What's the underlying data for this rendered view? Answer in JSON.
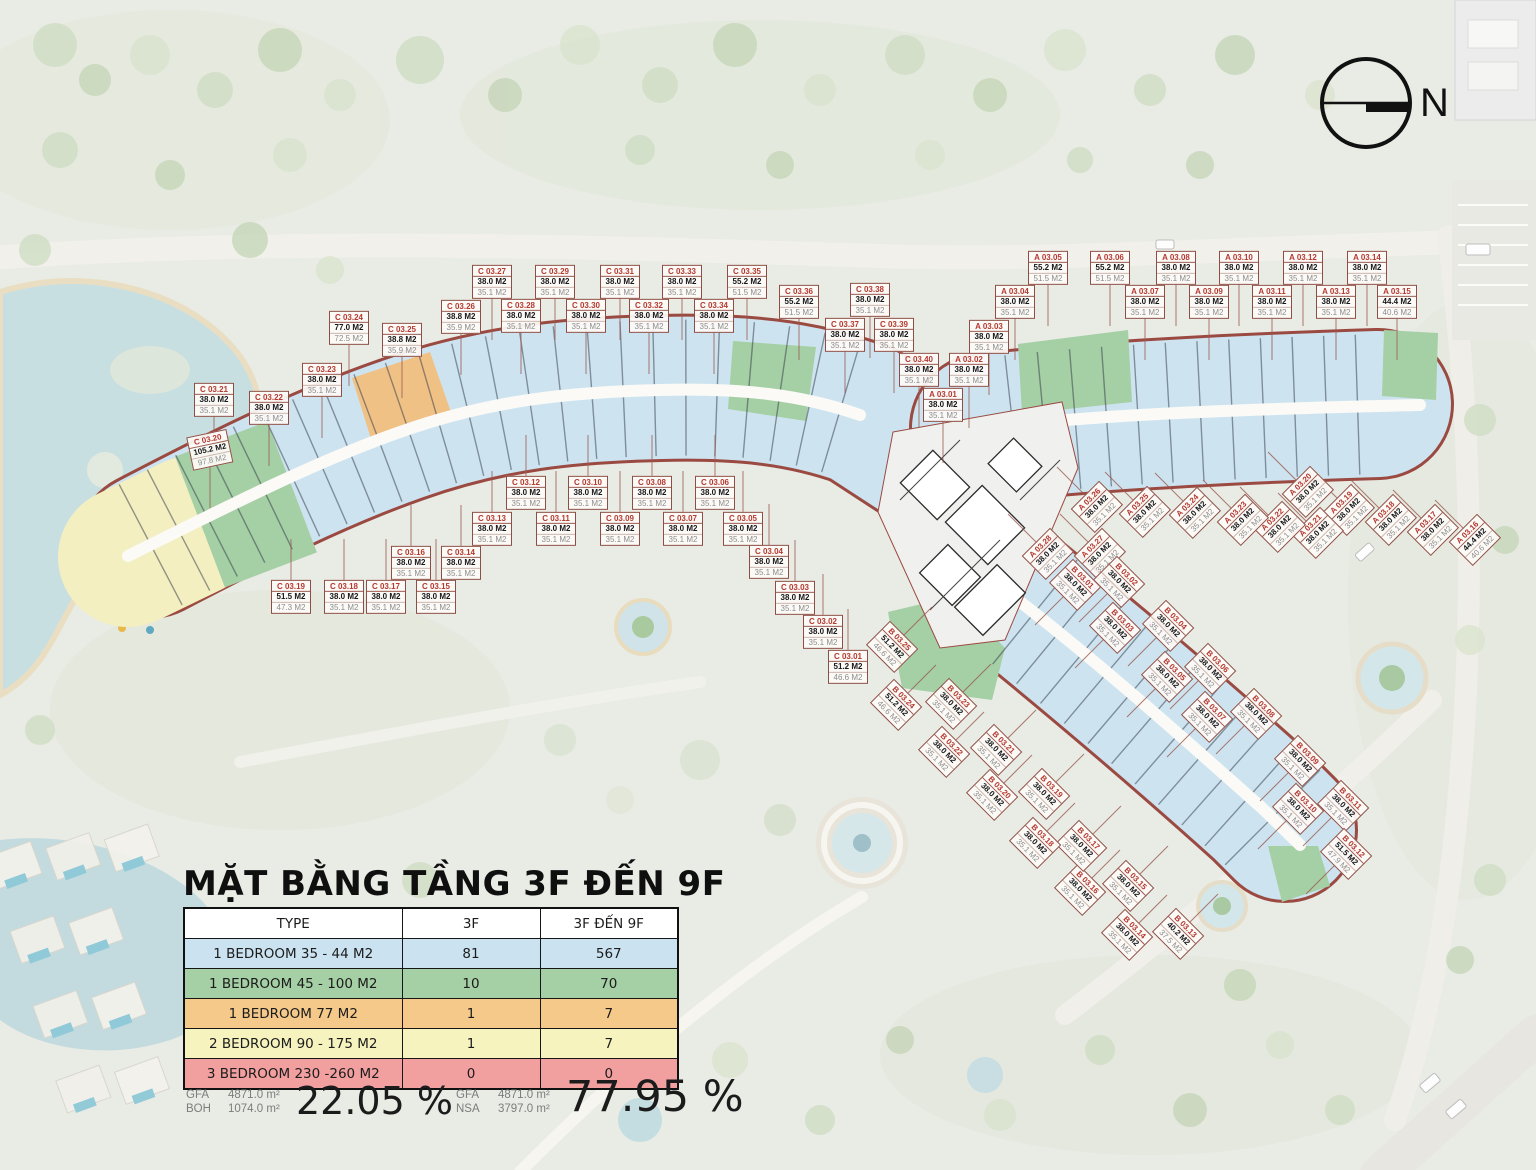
{
  "title": "MẶT BẰNG TẦNG 3F ĐẾN 9F",
  "compass": {
    "label": "N"
  },
  "legend_table": {
    "headers": [
      "TYPE",
      "3F",
      "3F ĐẾN 9F"
    ],
    "rows": [
      {
        "type": "1 BEDROOM 35 - 44 M2",
        "f3": "81",
        "f3_9": "567",
        "color": "#cbe3f1"
      },
      {
        "type": "1 BEDROOM 45 - 100 M2",
        "f3": "10",
        "f3_9": "70",
        "color": "#a5cfa4"
      },
      {
        "type": "1 BEDROOM 77 M2",
        "f3": "1",
        "f3_9": "7",
        "color": "#f5c98a"
      },
      {
        "type": "2 BEDROOM 90 - 175 M2",
        "f3": "1",
        "f3_9": "7",
        "color": "#f6f3bf"
      },
      {
        "type": "3 BEDROOM 230 -260 M2",
        "f3": "0",
        "f3_9": "0",
        "color": "#f19f9f"
      }
    ]
  },
  "stats": {
    "left": {
      "l1": "GFA",
      "v1": "4871.0 m²",
      "l2": "BOH",
      "v2": "1074.0 m²",
      "percent": "22.05 %"
    },
    "right": {
      "l1": "GFA",
      "v1": "4871.0 m²",
      "l2": "NSA",
      "v2": "3797.0 m²",
      "percent": "77.95 %"
    }
  },
  "colors": {
    "unit_blue": "#cde4f0",
    "unit_green": "#a5cfa4",
    "unit_orange": "#f0c185",
    "unit_yellow": "#f3efc0",
    "unit_red": "#f19f9f",
    "boundary_red": "#9b4a42"
  },
  "units": [
    [
      "C 03.01",
      "51.2 M2",
      "46.6 M2",
      848,
      667,
      0,
      "u"
    ],
    [
      "C 03.02",
      "38.0 M2",
      "35.1 M2",
      823,
      632,
      0,
      "u"
    ],
    [
      "C 03.03",
      "38.0 M2",
      "35.1 M2",
      795,
      598,
      0,
      "u"
    ],
    [
      "C 03.04",
      "38.0 M2",
      "35.1 M2",
      769,
      562,
      0,
      "u"
    ],
    [
      "C 03.05",
      "38.0 M2",
      "35.1 M2",
      743,
      529,
      0,
      "u"
    ],
    [
      "C 03.06",
      "38.0 M2",
      "35.1 M2",
      715,
      493,
      0,
      "u"
    ],
    [
      "C 03.07",
      "38.0 M2",
      "35.1 M2",
      683,
      529,
      0,
      "u"
    ],
    [
      "C 03.08",
      "38.0 M2",
      "35.1 M2",
      652,
      493,
      0,
      "u"
    ],
    [
      "C 03.09",
      "38.0 M2",
      "35.1 M2",
      620,
      529,
      0,
      "u"
    ],
    [
      "C 03.10",
      "38.0 M2",
      "35.1 M2",
      588,
      493,
      0,
      "u"
    ],
    [
      "C 03.11",
      "38.0 M2",
      "35.1 M2",
      556,
      529,
      0,
      "u"
    ],
    [
      "C 03.12",
      "38.0 M2",
      "35.1 M2",
      526,
      493,
      0,
      "u"
    ],
    [
      "C 03.13",
      "38.0 M2",
      "35.1 M2",
      492,
      529,
      0,
      "u"
    ],
    [
      "C 03.14",
      "38.0 M2",
      "35.1 M2",
      461,
      563,
      0,
      "u"
    ],
    [
      "C 03.15",
      "38.0 M2",
      "35.1 M2",
      436,
      597,
      0,
      "u"
    ],
    [
      "C 03.16",
      "38.0 M2",
      "35.1 M2",
      411,
      563,
      0,
      "u"
    ],
    [
      "C 03.17",
      "38.0 M2",
      "35.1 M2",
      386,
      597,
      0,
      "u"
    ],
    [
      "C 03.18",
      "38.0 M2",
      "35.1 M2",
      344,
      597,
      0,
      "u"
    ],
    [
      "C 03.19",
      "51.5 M2",
      "47.3 M2",
      291,
      597,
      0,
      "u"
    ],
    [
      "C 03.20",
      "105.2 M2",
      "97.8 M2",
      210,
      450,
      -12,
      "d"
    ],
    [
      "C 03.21",
      "38.0 M2",
      "35.1 M2",
      214,
      400,
      0,
      "d"
    ],
    [
      "C 03.22",
      "38.0 M2",
      "35.1 M2",
      269,
      408,
      0,
      "d"
    ],
    [
      "C 03.23",
      "38.0 M2",
      "35.1 M2",
      322,
      380,
      0,
      "d"
    ],
    [
      "C 03.24",
      "77.0 M2",
      "72.5 M2",
      349,
      328,
      0,
      "d"
    ],
    [
      "C 03.25",
      "38.8 M2",
      "35.9 M2",
      402,
      340,
      0,
      "d"
    ],
    [
      "C 03.26",
      "38.8 M2",
      "35.9 M2",
      461,
      317,
      0,
      "d"
    ],
    [
      "C 03.27",
      "38.0 M2",
      "35.1 M2",
      492,
      282,
      0,
      "d"
    ],
    [
      "C 03.28",
      "38.0 M2",
      "35.1 M2",
      521,
      316,
      0,
      "d"
    ],
    [
      "C 03.29",
      "38.0 M2",
      "35.1 M2",
      555,
      282,
      0,
      "d"
    ],
    [
      "C 03.30",
      "38.0 M2",
      "35.1 M2",
      586,
      316,
      0,
      "d"
    ],
    [
      "C 03.31",
      "38.0 M2",
      "35.1 M2",
      620,
      282,
      0,
      "d"
    ],
    [
      "C 03.32",
      "38.0 M2",
      "35.1 M2",
      649,
      316,
      0,
      "d"
    ],
    [
      "C 03.33",
      "38.0 M2",
      "35.1 M2",
      682,
      282,
      0,
      "d"
    ],
    [
      "C 03.34",
      "38.0 M2",
      "35.1 M2",
      714,
      316,
      0,
      "d"
    ],
    [
      "C 03.35",
      "55.2 M2",
      "51.5 M2",
      747,
      282,
      0,
      "d"
    ],
    [
      "C 03.36",
      "55.2 M2",
      "51.5 M2",
      799,
      302,
      0,
      "d"
    ],
    [
      "C 03.37",
      "38.0 M2",
      "35.1 M2",
      845,
      335,
      0,
      "d"
    ],
    [
      "C 03.38",
      "38.0 M2",
      "35.1 M2",
      870,
      300,
      0,
      "d"
    ],
    [
      "C 03.39",
      "38.0 M2",
      "35.1 M2",
      894,
      335,
      0,
      "d"
    ],
    [
      "C 03.40",
      "38.0 M2",
      "35.1 M2",
      919,
      370,
      0,
      "d"
    ],
    [
      "A 03.01",
      "38.0 M2",
      "35.1 M2",
      943,
      405,
      0,
      "d"
    ],
    [
      "A 03.02",
      "38.0 M2",
      "35.1 M2",
      969,
      370,
      0,
      "d"
    ],
    [
      "A 03.03",
      "38.0 M2",
      "35.1 M2",
      989,
      337,
      0,
      "d"
    ],
    [
      "A 03.04",
      "38.0 M2",
      "35.1 M2",
      1015,
      302,
      0,
      "d"
    ],
    [
      "A 03.05",
      "55.2 M2",
      "51.5 M2",
      1048,
      268,
      0,
      "d"
    ],
    [
      "A 03.06",
      "55.2 M2",
      "51.5 M2",
      1110,
      268,
      0,
      "d"
    ],
    [
      "A 03.07",
      "38.0 M2",
      "35.1 M2",
      1145,
      302,
      0,
      "d"
    ],
    [
      "A 03.08",
      "38.0 M2",
      "35.1 M2",
      1176,
      268,
      0,
      "d"
    ],
    [
      "A 03.09",
      "38.0 M2",
      "35.1 M2",
      1209,
      302,
      0,
      "d"
    ],
    [
      "A 03.10",
      "38.0 M2",
      "35.1 M2",
      1239,
      268,
      0,
      "d"
    ],
    [
      "A 03.11",
      "38.0 M2",
      "35.1 M2",
      1272,
      302,
      0,
      "d"
    ],
    [
      "A 03.12",
      "38.0 M2",
      "35.1 M2",
      1303,
      268,
      0,
      "d"
    ],
    [
      "A 03.13",
      "38.0 M2",
      "35.1 M2",
      1336,
      302,
      0,
      "d"
    ],
    [
      "A 03.14",
      "38.0 M2",
      "35.1 M2",
      1367,
      268,
      0,
      "d"
    ],
    [
      "A 03.15",
      "44.4 M2",
      "40.6 M2",
      1397,
      302,
      0,
      "d"
    ],
    [
      "A 03.16",
      "44.4 M2",
      "40.6 M2",
      1475,
      540,
      -45,
      "nw"
    ],
    [
      "A 03.17",
      "38.0 M2",
      "35.1 M2",
      1433,
      530,
      -45,
      "nw"
    ],
    [
      "A 03.18",
      "38.0 M2",
      "35.1 M2",
      1391,
      520,
      -45,
      "nw"
    ],
    [
      "A 03.19",
      "38.0 M2",
      "35.1 M2",
      1349,
      510,
      -45,
      "nw"
    ],
    [
      "A 03.20",
      "38.0 M2",
      "35.1 M2",
      1308,
      492,
      -45,
      "nw"
    ],
    [
      "A 03.21",
      "38.0 M2",
      "35.1 M2",
      1318,
      533,
      -45,
      "nw"
    ],
    [
      "A 03.22",
      "38.0 M2",
      "35.1 M2",
      1280,
      527,
      -45,
      "nw"
    ],
    [
      "A 03.23",
      "38.0 M2",
      "35.1 M2",
      1243,
      520,
      -45,
      "nw"
    ],
    [
      "A 03.24",
      "38.0 M2",
      "35.1 M2",
      1195,
      513,
      -45,
      "nw"
    ],
    [
      "A 03.25",
      "38.0 M2",
      "35.1 M2",
      1145,
      512,
      -45,
      "nw"
    ],
    [
      "A 03.26",
      "38.0 M2",
      "35.1 M2",
      1097,
      507,
      -45,
      "nw"
    ],
    [
      "A 03.27",
      "38.0 M2",
      "35.1 M2",
      1100,
      554,
      -45,
      "nw"
    ],
    [
      "A 03.28",
      "38.0 M2",
      "35.1 M2",
      1048,
      554,
      -45,
      "nw"
    ],
    [
      "B 03.01",
      "38.0 M2",
      "35.1 M2",
      1075,
      585,
      45,
      "sw"
    ],
    [
      "B 03.02",
      "38.0 M2",
      "35.1 M2",
      1119,
      582,
      45,
      "sw"
    ],
    [
      "B 03.03",
      "38.0 M2",
      "35.1 M2",
      1115,
      628,
      45,
      "sw"
    ],
    [
      "B 03.04",
      "38.0 M2",
      "35.1 M2",
      1168,
      626,
      45,
      "sw"
    ],
    [
      "B 03.05",
      "38.0 M2",
      "35.1 M2",
      1167,
      677,
      45,
      "sw"
    ],
    [
      "B 03.06",
      "38.0 M2",
      "35.1 M2",
      1210,
      669,
      45,
      "sw"
    ],
    [
      "B 03.07",
      "38.0 M2",
      "35.1 M2",
      1207,
      717,
      45,
      "sw"
    ],
    [
      "B 03.08",
      "38.0 M2",
      "35.1 M2",
      1256,
      714,
      45,
      "sw"
    ],
    [
      "B 03.09",
      "38.0 M2",
      "35.1 M2",
      1300,
      761,
      45,
      "sw"
    ],
    [
      "B 03.10",
      "38.0 M2",
      "35.1 M2",
      1298,
      809,
      45,
      "sw"
    ],
    [
      "B 03.11",
      "38.0 M2",
      "35.1 M2",
      1343,
      806,
      45,
      "sw"
    ],
    [
      "B 03.12",
      "51.5 M2",
      "47.9 M2",
      1346,
      854,
      45,
      "sw"
    ],
    [
      "B 03.13",
      "40.2 M2",
      "37.5 M2",
      1178,
      934,
      45,
      "ne"
    ],
    [
      "B 03.14",
      "38.0 M2",
      "35.1 M2",
      1127,
      935,
      45,
      "ne"
    ],
    [
      "B 03.15",
      "38.0 M2",
      "35.1 M2",
      1128,
      886,
      45,
      "ne"
    ],
    [
      "B 03.16",
      "38.0 M2",
      "35.1 M2",
      1080,
      890,
      45,
      "ne"
    ],
    [
      "B 03.17",
      "38.0 M2",
      "35.1 M2",
      1081,
      846,
      45,
      "ne"
    ],
    [
      "B 03.18",
      "38.0 M2",
      "35.1 M2",
      1035,
      843,
      45,
      "ne"
    ],
    [
      "B 03.19",
      "38.0 M2",
      "35.1 M2",
      1044,
      794,
      45,
      "ne"
    ],
    [
      "B 03.20",
      "38.0 M2",
      "35.1 M2",
      992,
      795,
      45,
      "ne"
    ],
    [
      "B 03.21",
      "38.0 M2",
      "35.1 M2",
      996,
      750,
      45,
      "ne"
    ],
    [
      "B 03.22",
      "38.0 M2",
      "35.1 M2",
      944,
      752,
      45,
      "ne"
    ],
    [
      "B 03.23",
      "38.0 M2",
      "35.1 M2",
      951,
      704,
      45,
      "ne"
    ],
    [
      "B 03.24",
      "51.2 M2",
      "46.6 M2",
      896,
      705,
      45,
      "ne"
    ],
    [
      "B 03.25",
      "51.2 M2",
      "46.6 M2",
      892,
      647,
      45,
      "ne"
    ]
  ]
}
